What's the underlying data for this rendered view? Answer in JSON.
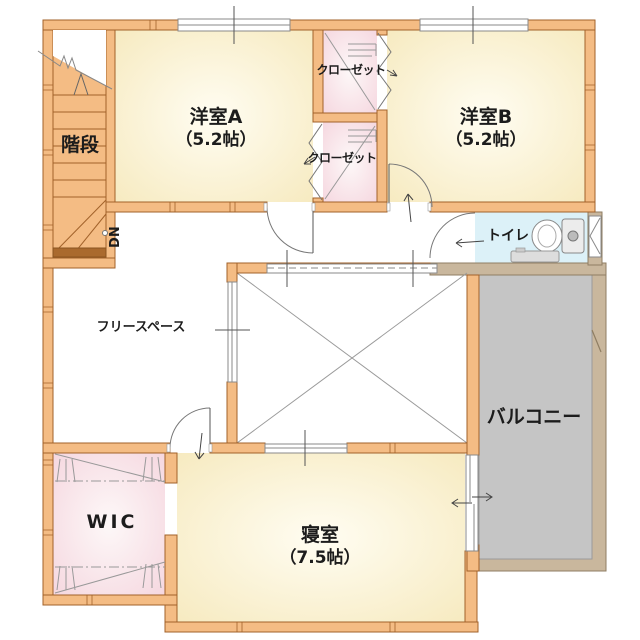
{
  "floor_plan": {
    "rooms": {
      "stairs": {
        "label": "階段"
      },
      "stair_direction": {
        "label": "DN"
      },
      "western_room_a": {
        "label": "洋室A",
        "size": "（5.2帖）"
      },
      "western_room_b": {
        "label": "洋室B",
        "size": "（5.2帖）"
      },
      "closet_upper": {
        "label": "クローゼット"
      },
      "closet_lower": {
        "label": "クローゼット"
      },
      "toilet": {
        "label": "トイレ"
      },
      "free_space": {
        "label": "フリースペース"
      },
      "balcony": {
        "label": "バルコニー"
      },
      "walk_in_closet": {
        "label": "WIC"
      },
      "bedroom": {
        "label": "寝室",
        "size": "（7.5帖）"
      }
    },
    "colors": {
      "wall_fill": "#f4bc84",
      "wall_outline": "#a2622a",
      "room_floor": "#f8eec6",
      "closet_floor": "#f6d8df",
      "toilet_floor": "#dcf1f8",
      "balcony_floor": "#c5c5c5",
      "balcony_wall": "#c9b79d",
      "background": "#ffffff"
    }
  }
}
